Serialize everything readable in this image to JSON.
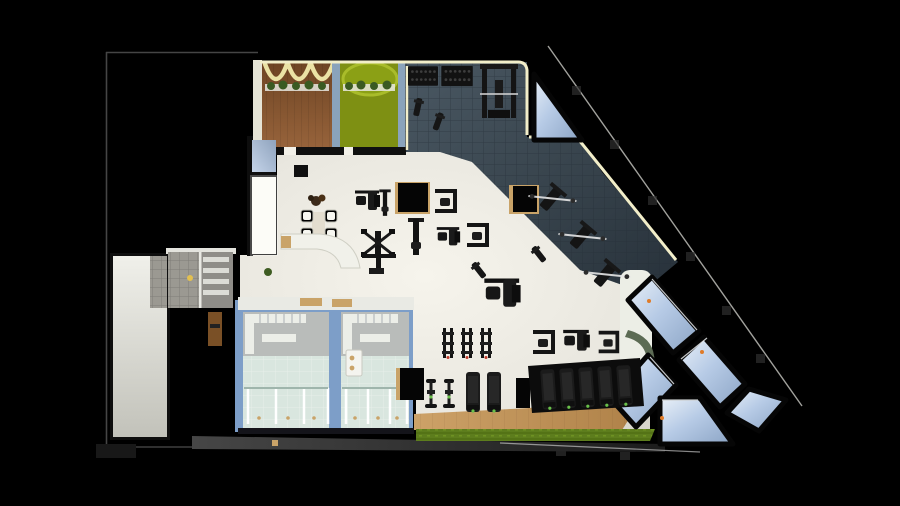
{
  "scene": {
    "name": "gym-interior-3d-floor-plan",
    "view": "top-down-architectural-render",
    "background_color": "#000000"
  },
  "colors": {
    "background": "#000000",
    "wall_black": "#0a0a0a",
    "wall_glow_cream": "#f2eec9",
    "site_line_gray": "#454545",
    "site_line_white": "#d8d8d2",
    "bottom_wall_gray": "#3a3a3a",
    "hall_floor_bright": "#f6f4ec",
    "hall_floor": "#e9e7df",
    "hall_floor_dim": "#d8d6cc",
    "tile_light": "#4a5863",
    "tile_mid": "#39454e",
    "tile_deep": "#27313a",
    "tile_line": "#2b353d",
    "wood_light": "#98643c",
    "wood_dark": "#6e4423",
    "studio_green": "#7e9013",
    "studio_green_light": "#a9bc2a",
    "planter_green": "#3a5a22",
    "wall_blue": "#8aa3bb",
    "locker_wall_blue": "#7d9ec8",
    "locker_floor_gray": "#b9bcba",
    "shower_glass": "#d9e6df",
    "shower_frame": "#9fb5ac",
    "glass_light": "#eaf1f8",
    "glass_mid": "#b7cbe6",
    "glass_deep": "#8aa3c4",
    "cardio_wood_light": "#cda268",
    "cardio_wood_dark": "#ad7f46",
    "turf_green": "#5d7d1d",
    "turf_green_dark": "#547316",
    "counter_wood": "#c9a368",
    "door_brown": "#7a5026",
    "partition_white": "#eceee6",
    "curved_wall_sage": "#5c6b54",
    "equipment_black": "#161616",
    "equipment_gray": "#2e2e2e",
    "console_green": "#69c04a",
    "accent_red": "#c03a2a",
    "accent_orange": "#e07b28",
    "gold_light": "#e3c050",
    "gray_tile_floor": "#9b9992",
    "corridor_floor": "#e4e4de",
    "barbell_white": "#e6e6e6"
  },
  "zones": [
    {
      "id": "studio-wood",
      "label": "group-exercise-studio-wood-floor"
    },
    {
      "id": "studio-green",
      "label": "group-exercise-studio-green-floor"
    },
    {
      "id": "free-weights-zone",
      "label": "free-weights-rubber-tile-zone"
    },
    {
      "id": "machines-hall",
      "label": "strength-machines-hall"
    },
    {
      "id": "cardio-zone",
      "label": "cardio-zone-wood-and-turf"
    },
    {
      "id": "locker-rooms",
      "label": "locker-and-shower-rooms"
    },
    {
      "id": "reception-lounge",
      "label": "reception-lounge-seating"
    },
    {
      "id": "corridor",
      "label": "service-corridor"
    },
    {
      "id": "restroom",
      "label": "restroom-gray-tile"
    },
    {
      "id": "storage",
      "label": "storage-shelf-room"
    },
    {
      "id": "glass-terrace",
      "label": "glass-skylight-terrace-panels"
    },
    {
      "id": "balcony-triangle",
      "label": "triangular-glass-balcony"
    }
  ],
  "equipment_inventory": {
    "treadmills": 7,
    "spin_bikes": 5,
    "vertical_racks": 3,
    "strength_machines": 12,
    "dumbbell_racks": 2,
    "power_rack": 1,
    "benches_with_barbell": 3,
    "small_benches": 4,
    "lounge_chairs": 4,
    "lounge_table": 1,
    "reception_desk": 1,
    "shower_stalls": 6,
    "wall_tv": 1,
    "plants": 3
  }
}
